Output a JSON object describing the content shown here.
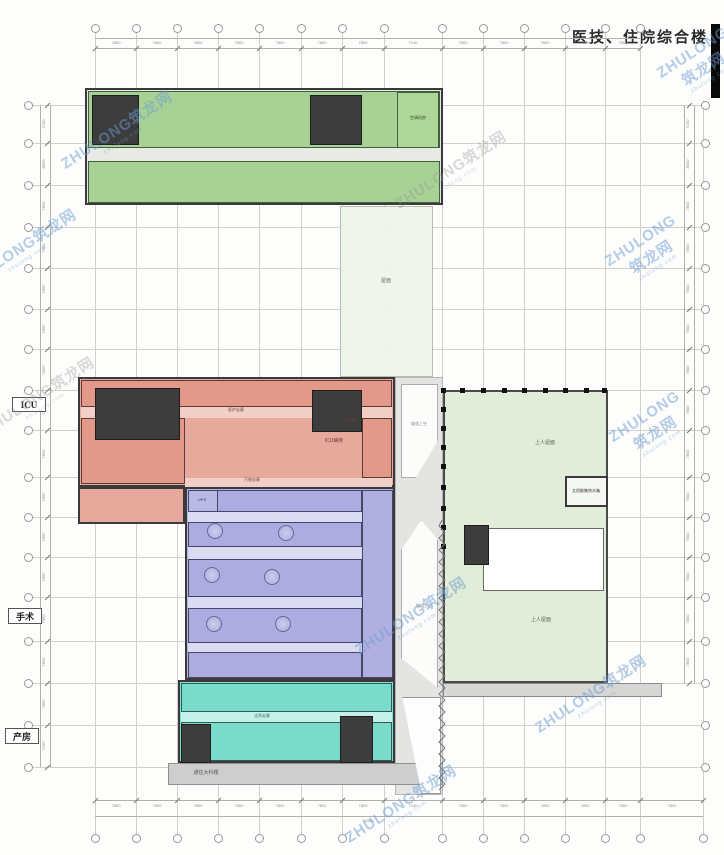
{
  "title": {
    "text": "医技、住院综合楼"
  },
  "watermark": {
    "main": "ZHULONG筑龙网",
    "sub": "zhulong.com",
    "blue": "rgba(108,156,210,0.5)",
    "gray": "rgba(150,150,150,0.35)"
  },
  "watermarks": [
    {
      "x": 118,
      "y": 132,
      "c": "blue"
    },
    {
      "x": 22,
      "y": 250,
      "c": "blue"
    },
    {
      "x": 452,
      "y": 172,
      "c": "gray"
    },
    {
      "x": 648,
      "y": 252,
      "c": "blue"
    },
    {
      "x": 40,
      "y": 398,
      "c": "gray"
    },
    {
      "x": 652,
      "y": 428,
      "c": "blue"
    },
    {
      "x": 412,
      "y": 618,
      "c": "blue"
    },
    {
      "x": 592,
      "y": 696,
      "c": "blue"
    },
    {
      "x": 402,
      "y": 806,
      "c": "blue"
    },
    {
      "x": 700,
      "y": 64,
      "c": "blue"
    }
  ],
  "side_labels": [
    {
      "text": "ICU",
      "x": 12,
      "y": 397,
      "w": 34,
      "h": 15
    },
    {
      "text": "手术",
      "x": 8,
      "y": 608,
      "w": 34,
      "h": 16
    },
    {
      "text": "产房",
      "x": 5,
      "y": 728,
      "w": 34,
      "h": 16
    }
  ],
  "grid": {
    "cols_x": [
      95,
      136,
      177,
      218,
      259,
      301,
      342,
      384,
      442,
      483,
      524,
      565,
      605,
      640
    ],
    "col_right": 703,
    "rows_y": [
      105,
      143,
      185,
      227,
      268,
      309,
      349,
      390,
      430,
      477,
      517,
      557,
      597,
      641,
      683,
      725,
      767
    ]
  },
  "dimensions": {
    "top": [
      "7800",
      "7800",
      "7800",
      "7800",
      "7800",
      "7800",
      "7800",
      "7140",
      "7800",
      "7800",
      "7800",
      "7800",
      "7800"
    ],
    "bottom": [
      "7800",
      "7800",
      "7800",
      "7800",
      "7800",
      "7800",
      "7800",
      "7140",
      "7800",
      "7800",
      "7800",
      "7800",
      "7800",
      "7800"
    ],
    "left": [
      "7200",
      "8000",
      "7800",
      "7800",
      "7800",
      "7800",
      "7800",
      "7800",
      "7800",
      "7800",
      "7800",
      "7800",
      "7800",
      "7800",
      "7800",
      "7200"
    ],
    "right": [
      "7200",
      "8000",
      "7800",
      "7800",
      "7800",
      "7800",
      "7800",
      "7800",
      "7800",
      "7800",
      "7800",
      "7800",
      "7800",
      "7800",
      "7800",
      "7200"
    ],
    "total_bottom": "51060"
  },
  "blocks": [
    {
      "name": "mid-roof-strip",
      "x": 340,
      "y": 206,
      "w": 93,
      "h": 171,
      "fill": "rgba(238,244,232,0.92)",
      "stroke": "#b8bdb4",
      "sw": 1
    },
    {
      "name": "right-roof",
      "x": 443,
      "y": 390,
      "w": 165,
      "h": 293,
      "fill": "rgba(223,236,214,0.92)",
      "stroke": "#4a4a4a",
      "sw": 2
    },
    {
      "name": "roof-void",
      "x": 483,
      "y": 528,
      "w": 121,
      "h": 63,
      "fill": "#ffffff",
      "stroke": "#6a6a6a",
      "sw": 1
    },
    {
      "name": "roof-stair-core",
      "x": 464,
      "y": 525,
      "w": 25,
      "h": 40,
      "fill": "#3d3d3d",
      "stroke": "#1e1e1e",
      "sw": 1,
      "pattern": "core"
    },
    {
      "name": "solar-tank-room",
      "x": 565,
      "y": 476,
      "w": 43,
      "h": 31,
      "fill": "#f6f9f3",
      "stroke": "#3a3a3a",
      "sw": 2
    },
    {
      "name": "ramp-corridor",
      "x": 395,
      "y": 377,
      "w": 48,
      "h": 418,
      "fill": "#e4e4e2",
      "stroke": "#b5b5b5",
      "sw": 1
    },
    {
      "name": "ramp-void-upper",
      "x": 401,
      "y": 384,
      "w": 37,
      "h": 94,
      "fill": "#fcfcfb",
      "stroke": "#adadad",
      "sw": 1,
      "clip": "polygon(0 0,100% 0,100% 60%,40% 100%,0 100%)"
    },
    {
      "name": "ramp-void-lower",
      "x": 401,
      "y": 520,
      "w": 37,
      "h": 168,
      "fill": "#fcfcfb",
      "stroke": "#adadad",
      "sw": 1,
      "clip": "polygon(0 18%,55% 0,100% 12%,100% 100%,0 82%)"
    },
    {
      "name": "walkway-band",
      "x": 443,
      "y": 683,
      "w": 219,
      "h": 14,
      "fill": "#d7d7d5",
      "stroke": "#8a8a8a",
      "sw": 1
    },
    {
      "name": "south-band",
      "x": 168,
      "y": 763,
      "w": 275,
      "h": 22,
      "fill": "#cecece",
      "stroke": "#909090",
      "sw": 1
    },
    {
      "name": "entrance-void",
      "x": 398,
      "y": 697,
      "w": 43,
      "h": 97,
      "fill": "#fdfdfd",
      "stroke": "#9a9a9a",
      "sw": 1,
      "clip": "polygon(10% 0,100% 0,100% 100%,55% 100%)"
    },
    {
      "name": "north-wing",
      "x": 85,
      "y": 88,
      "w": 358,
      "h": 117,
      "fill": "#e6e8e4",
      "stroke": "#3a3a3a",
      "sw": 2
    },
    {
      "name": "north-wing-upper-rooms",
      "x": 88,
      "y": 91,
      "w": 352,
      "h": 57,
      "fill": "#a8d295",
      "stroke": "#41603c",
      "sw": 1,
      "pattern": "rooms"
    },
    {
      "name": "north-wing-corridor",
      "x": 88,
      "y": 148,
      "w": 352,
      "h": 13,
      "fill": "#e9eae6"
    },
    {
      "name": "north-wing-lower-rooms",
      "x": 88,
      "y": 161,
      "w": 352,
      "h": 42,
      "fill": "#a8d295",
      "stroke": "#41603c",
      "sw": 1,
      "pattern": "rooms"
    },
    {
      "name": "north-core-west",
      "x": 92,
      "y": 95,
      "w": 47,
      "h": 50,
      "fill": "#3d3d3d",
      "stroke": "#1e1e1e",
      "sw": 1,
      "pattern": "core"
    },
    {
      "name": "north-core-mid",
      "x": 310,
      "y": 95,
      "w": 52,
      "h": 50,
      "fill": "#3d3d3d",
      "stroke": "#1e1e1e",
      "sw": 1,
      "pattern": "core"
    },
    {
      "name": "ahu-room",
      "x": 397,
      "y": 92,
      "w": 42,
      "h": 56,
      "fill": "#aed698",
      "stroke": "#41603c",
      "sw": 1
    },
    {
      "name": "icu-block",
      "x": 78,
      "y": 377,
      "w": 317,
      "h": 110,
      "fill": "#e7a99b",
      "stroke": "#3a3a3a",
      "sw": 2
    },
    {
      "name": "icu-west-leg",
      "x": 78,
      "y": 487,
      "w": 107,
      "h": 37,
      "fill": "#e7a99b",
      "stroke": "#3a3a3a",
      "sw": 2,
      "pattern": "rooms"
    },
    {
      "name": "icu-upper-rooms",
      "x": 81,
      "y": 380,
      "w": 311,
      "h": 27,
      "fill": "#e2998a",
      "stroke": "#5d3a33",
      "sw": 1,
      "pattern": "rooms"
    },
    {
      "name": "icu-corridor",
      "x": 81,
      "y": 407,
      "w": 311,
      "h": 11,
      "fill": "#f2cfc6"
    },
    {
      "name": "icu-mid-rooms",
      "x": 81,
      "y": 418,
      "w": 104,
      "h": 66,
      "fill": "#e2998a",
      "stroke": "#5d3a33",
      "sw": 1,
      "pattern": "rooms"
    },
    {
      "name": "icu-ward",
      "x": 185,
      "y": 418,
      "w": 177,
      "h": 60,
      "fill": "#e7a99b",
      "pattern": "beds"
    },
    {
      "name": "icu-right-rooms",
      "x": 362,
      "y": 418,
      "w": 30,
      "h": 60,
      "fill": "#e2998a",
      "stroke": "#5d3a33",
      "sw": 1,
      "pattern": "roomsH"
    },
    {
      "name": "icu-soil-corridor",
      "x": 185,
      "y": 478,
      "w": 207,
      "h": 9,
      "fill": "#f2cfc6"
    },
    {
      "name": "icu-core-west",
      "x": 95,
      "y": 388,
      "w": 85,
      "h": 52,
      "fill": "#3d3d3d",
      "stroke": "#1e1e1e",
      "sw": 1,
      "pattern": "core"
    },
    {
      "name": "icu-core-east",
      "x": 312,
      "y": 390,
      "w": 50,
      "h": 42,
      "fill": "#3d3d3d",
      "stroke": "#1e1e1e",
      "sw": 1,
      "pattern": "core"
    },
    {
      "name": "surgery-block",
      "x": 185,
      "y": 487,
      "w": 210,
      "h": 193,
      "fill": "#b5b5e2",
      "stroke": "#3a3a3a",
      "sw": 2
    },
    {
      "name": "surgery-rooms-1",
      "x": 188,
      "y": 490,
      "w": 174,
      "h": 22,
      "fill": "#acace0",
      "stroke": "#46466b",
      "sw": 1,
      "pattern": "rooms"
    },
    {
      "name": "surgery-corridor-1",
      "x": 188,
      "y": 512,
      "w": 174,
      "h": 10,
      "fill": "#dadaf0"
    },
    {
      "name": "surgery-rooms-2",
      "x": 188,
      "y": 522,
      "w": 174,
      "h": 25,
      "fill": "#acace0",
      "stroke": "#46466b",
      "sw": 1,
      "pattern": "rooms30"
    },
    {
      "name": "surgery-corridor-2",
      "x": 188,
      "y": 547,
      "w": 174,
      "h": 12,
      "fill": "#dadaf0"
    },
    {
      "name": "surgery-rooms-3",
      "x": 188,
      "y": 559,
      "w": 174,
      "h": 38,
      "fill": "#acace0",
      "stroke": "#46466b",
      "sw": 1,
      "pattern": "rooms30"
    },
    {
      "name": "surgery-corridor-3",
      "x": 188,
      "y": 597,
      "w": 174,
      "h": 11,
      "fill": "#dadaf0"
    },
    {
      "name": "surgery-rooms-4",
      "x": 188,
      "y": 608,
      "w": 174,
      "h": 35,
      "fill": "#acace0",
      "stroke": "#46466b",
      "sw": 1,
      "pattern": "rooms30"
    },
    {
      "name": "surgery-corridor-4",
      "x": 188,
      "y": 643,
      "w": 174,
      "h": 9,
      "fill": "#dadaf0"
    },
    {
      "name": "surgery-rooms-5",
      "x": 188,
      "y": 652,
      "w": 174,
      "h": 26,
      "fill": "#acace0",
      "stroke": "#46466b",
      "sw": 1,
      "pattern": "rooms"
    },
    {
      "name": "surgery-east-rooms",
      "x": 362,
      "y": 490,
      "w": 31,
      "h": 188,
      "fill": "#b0b0e0",
      "stroke": "#46466b",
      "sw": 1,
      "pattern": "roomsH"
    },
    {
      "name": "ups-room",
      "x": 188,
      "y": 490,
      "w": 30,
      "h": 22,
      "fill": "#b9b9e6",
      "stroke": "#46466b",
      "sw": 1
    },
    {
      "name": "delivery-block",
      "x": 178,
      "y": 680,
      "w": 217,
      "h": 83,
      "fill": "#7fe0cf",
      "stroke": "#3a3a3a",
      "sw": 2
    },
    {
      "name": "delivery-rooms-1",
      "x": 181,
      "y": 683,
      "w": 211,
      "h": 29,
      "fill": "#79dbc9",
      "stroke": "#2e5d55",
      "sw": 1,
      "pattern": "rooms"
    },
    {
      "name": "delivery-corridor",
      "x": 181,
      "y": 712,
      "w": 211,
      "h": 10,
      "fill": "#c6f1e8"
    },
    {
      "name": "delivery-rooms-2",
      "x": 181,
      "y": 722,
      "w": 211,
      "h": 39,
      "fill": "#79dbc9",
      "stroke": "#2e5d55",
      "sw": 1,
      "pattern": "rooms"
    },
    {
      "name": "delivery-core-west",
      "x": 181,
      "y": 724,
      "w": 30,
      "h": 39,
      "fill": "#3d3d3d",
      "stroke": "#1e1e1e",
      "sw": 1,
      "pattern": "core"
    },
    {
      "name": "delivery-core-east",
      "x": 340,
      "y": 716,
      "w": 33,
      "h": 47,
      "fill": "#3d3d3d",
      "stroke": "#1e1e1e",
      "sw": 1,
      "pattern": "core"
    }
  ],
  "or_tables": [
    {
      "x": 215,
      "y": 531
    },
    {
      "x": 286,
      "y": 533
    },
    {
      "x": 212,
      "y": 575
    },
    {
      "x": 272,
      "y": 577
    },
    {
      "x": 214,
      "y": 624
    },
    {
      "x": 283,
      "y": 624
    }
  ],
  "columns": [
    {
      "x": 443,
      "y": 390
    },
    {
      "x": 443,
      "y": 409
    },
    {
      "x": 443,
      "y": 428
    },
    {
      "x": 443,
      "y": 447
    },
    {
      "x": 443,
      "y": 466
    },
    {
      "x": 443,
      "y": 487
    },
    {
      "x": 443,
      "y": 508
    },
    {
      "x": 443,
      "y": 527
    },
    {
      "x": 443,
      "y": 546
    },
    {
      "x": 462,
      "y": 390
    },
    {
      "x": 483,
      "y": 390
    },
    {
      "x": 504,
      "y": 390
    },
    {
      "x": 524,
      "y": 390
    },
    {
      "x": 545,
      "y": 390
    },
    {
      "x": 565,
      "y": 390
    },
    {
      "x": 586,
      "y": 390
    },
    {
      "x": 604,
      "y": 390
    }
  ],
  "zigzags": [
    {
      "x": 438,
      "y": 520,
      "h": 275
    }
  ],
  "plan_labels": [
    {
      "t": "屋面",
      "x": 386,
      "y": 281,
      "s": 5,
      "c": "#667160"
    },
    {
      "t": "上人屋面",
      "x": 545,
      "y": 443,
      "s": 5,
      "c": "#5a6a55"
    },
    {
      "t": "上人屋面",
      "x": 541,
      "y": 620,
      "s": 5,
      "c": "#5a6a55"
    },
    {
      "t": "太阳能集热水箱",
      "x": 586,
      "y": 491,
      "s": 4,
      "c": "#333333"
    },
    {
      "t": "空调机房",
      "x": 418,
      "y": 118,
      "s": 4,
      "c": "#2c4a28"
    },
    {
      "t": "医护走廊",
      "x": 236,
      "y": 410,
      "s": 4,
      "c": "#7a443a"
    },
    {
      "t": "护士站",
      "x": 350,
      "y": 420,
      "s": 4,
      "c": "#7a443a"
    },
    {
      "t": "ICU病房",
      "x": 334,
      "y": 441,
      "s": 5,
      "c": "#6d3a30"
    },
    {
      "t": "污物走廊",
      "x": 252,
      "y": 480,
      "s": 4,
      "c": "#7a443a"
    },
    {
      "t": "UPS",
      "x": 202,
      "y": 500,
      "s": 4,
      "c": "#333a6b"
    },
    {
      "t": "洁净走廊",
      "x": 262,
      "y": 716,
      "s": 4,
      "c": "#2c6b60"
    },
    {
      "t": "通往大科楼",
      "x": 206,
      "y": 773,
      "s": 5,
      "c": "#555555"
    },
    {
      "t": "坡道上空",
      "x": 419,
      "y": 424,
      "s": 4,
      "c": "#888888"
    },
    {
      "t": "坡道上空",
      "x": 424,
      "y": 606,
      "s": 4,
      "c": "#888888"
    }
  ]
}
